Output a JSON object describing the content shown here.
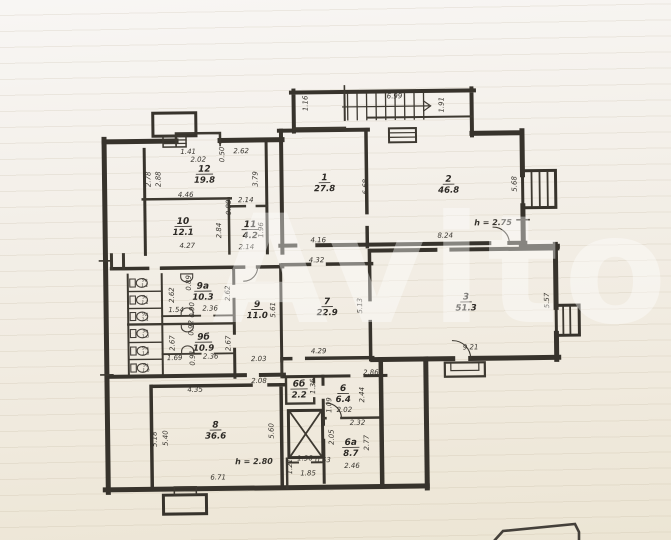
{
  "photo": {
    "watermark": "Avito",
    "colors": {
      "paper": "#f2eee6",
      "ink": "#37332c",
      "watermark": "#ffffff"
    }
  },
  "plan": {
    "rooms": [
      {
        "num": "1",
        "area": "27.8",
        "x": 326,
        "y": 180
      },
      {
        "num": "2",
        "area": "46.8",
        "x": 450,
        "y": 183
      },
      {
        "num": "3",
        "area": "51.3",
        "x": 466,
        "y": 301
      },
      {
        "num": "6",
        "area": "6.4",
        "x": 342,
        "y": 391
      },
      {
        "num": "6а",
        "area": "8.7",
        "x": 349,
        "y": 445
      },
      {
        "num": "6б",
        "area": "2.2",
        "x": 298,
        "y": 386
      },
      {
        "num": "7",
        "area": "22.9",
        "x": 327,
        "y": 304
      },
      {
        "num": "8",
        "area": "36.6",
        "x": 214,
        "y": 426
      },
      {
        "num": "9",
        "area": "11.0",
        "x": 257,
        "y": 306
      },
      {
        "num": "9а",
        "area": "10.3",
        "x": 203,
        "y": 287
      },
      {
        "num": "9б",
        "area": "10.9",
        "x": 203,
        "y": 338
      },
      {
        "num": "10",
        "area": "12.1",
        "x": 184,
        "y": 222
      },
      {
        "num": "11",
        "area": "4.2",
        "x": 251,
        "y": 226
      },
      {
        "num": "12",
        "area": "19.8",
        "x": 206,
        "y": 170
      }
    ],
    "stalls": [
      {
        "num": "9в",
        "area": "1.1",
        "x": 145,
        "y": 279
      },
      {
        "num": "9г",
        "area": "1.1",
        "x": 145,
        "y": 296
      },
      {
        "num": "9д",
        "area": "1.1",
        "x": 145,
        "y": 313
      },
      {
        "num": "9е",
        "area": "1.0",
        "x": 145,
        "y": 330
      },
      {
        "num": "9ж",
        "area": "1.0",
        "x": 145,
        "y": 347
      },
      {
        "num": "9з",
        "area": "1.0",
        "x": 145,
        "y": 364
      }
    ],
    "dims": [
      {
        "t": "1.16",
        "x": 310,
        "y": 103,
        "v": 1
      },
      {
        "t": "6.99",
        "x": 397,
        "y": 99,
        "v": 0
      },
      {
        "t": "1.91",
        "x": 446,
        "y": 106,
        "v": 1
      },
      {
        "t": "1.41",
        "x": 190,
        "y": 152,
        "v": 0
      },
      {
        "t": "2.02",
        "x": 200,
        "y": 160,
        "v": 0
      },
      {
        "t": "0.50",
        "x": 226,
        "y": 153,
        "v": 1
      },
      {
        "t": "2.62",
        "x": 243,
        "y": 152,
        "v": 0
      },
      {
        "t": "2.78",
        "x": 152,
        "y": 177,
        "v": 1
      },
      {
        "t": "2.88",
        "x": 162,
        "y": 177,
        "v": 1
      },
      {
        "t": "3.79",
        "x": 259,
        "y": 178,
        "v": 1
      },
      {
        "t": "4.46",
        "x": 187,
        "y": 195,
        "v": 0
      },
      {
        "t": "2.14",
        "x": 247,
        "y": 201,
        "v": 0
      },
      {
        "t": "0.89",
        "x": 232,
        "y": 206,
        "v": 1
      },
      {
        "t": "2.84",
        "x": 222,
        "y": 229,
        "v": 1
      },
      {
        "t": "1.96",
        "x": 264,
        "y": 229,
        "v": 1
      },
      {
        "t": "4.27",
        "x": 188,
        "y": 246,
        "v": 0
      },
      {
        "t": "2.14",
        "x": 247,
        "y": 248,
        "v": 0
      },
      {
        "t": "6.68",
        "x": 369,
        "y": 187,
        "v": 1
      },
      {
        "t": "4.16",
        "x": 319,
        "y": 242,
        "v": 0
      },
      {
        "t": "5.68",
        "x": 518,
        "y": 186,
        "v": 1
      },
      {
        "t": "8.24",
        "x": 446,
        "y": 239,
        "v": 0
      },
      {
        "t": "4.32",
        "x": 317,
        "y": 262,
        "v": 0
      },
      {
        "t": "5.13",
        "x": 362,
        "y": 306,
        "v": 1
      },
      {
        "t": "4.29",
        "x": 318,
        "y": 353,
        "v": 0
      },
      {
        "t": "5.57",
        "x": 549,
        "y": 303,
        "v": 1
      },
      {
        "t": "9.21",
        "x": 470,
        "y": 351,
        "v": 0
      },
      {
        "t": "5.61",
        "x": 275,
        "y": 309,
        "v": 1
      },
      {
        "t": "2.03",
        "x": 258,
        "y": 360,
        "v": 0
      },
      {
        "t": "2.08",
        "x": 258,
        "y": 382,
        "v": 0
      },
      {
        "t": "0.89",
        "x": 191,
        "y": 281,
        "v": 1
      },
      {
        "t": "2.62",
        "x": 174,
        "y": 293,
        "v": 1
      },
      {
        "t": "2.62",
        "x": 230,
        "y": 292,
        "v": 1
      },
      {
        "t": "1.54",
        "x": 176,
        "y": 310,
        "v": 0
      },
      {
        "t": "0.90",
        "x": 194,
        "y": 308,
        "v": 1
      },
      {
        "t": "2.36",
        "x": 210,
        "y": 309,
        "v": 0
      },
      {
        "t": "0.92",
        "x": 193,
        "y": 326,
        "v": 1
      },
      {
        "t": "2.67",
        "x": 174,
        "y": 341,
        "v": 1
      },
      {
        "t": "2.67",
        "x": 230,
        "y": 342,
        "v": 1
      },
      {
        "t": "1.69",
        "x": 174,
        "y": 358,
        "v": 0
      },
      {
        "t": "0.91",
        "x": 194,
        "y": 356,
        "v": 1
      },
      {
        "t": "2.36",
        "x": 210,
        "y": 357,
        "v": 0
      },
      {
        "t": "4.35",
        "x": 194,
        "y": 390,
        "v": 0
      },
      {
        "t": "5.18",
        "x": 155,
        "y": 437,
        "v": 1
      },
      {
        "t": "5.40",
        "x": 166,
        "y": 436,
        "v": 1
      },
      {
        "t": "5.60",
        "x": 272,
        "y": 430,
        "v": 1
      },
      {
        "t": "6.71",
        "x": 216,
        "y": 478,
        "v": 0
      },
      {
        "t": "2.86",
        "x": 370,
        "y": 375,
        "v": 0
      },
      {
        "t": "1.36",
        "x": 314,
        "y": 386,
        "v": 1
      },
      {
        "t": "2.44",
        "x": 363,
        "y": 395,
        "v": 1
      },
      {
        "t": "1.09",
        "x": 330,
        "y": 405,
        "v": 1
      },
      {
        "t": "2.02",
        "x": 343,
        "y": 412,
        "v": 0
      },
      {
        "t": "2.32",
        "x": 356,
        "y": 425,
        "v": 0
      },
      {
        "t": "2.05",
        "x": 332,
        "y": 437,
        "v": 1
      },
      {
        "t": "2.77",
        "x": 367,
        "y": 443,
        "v": 1
      },
      {
        "t": "2.46",
        "x": 350,
        "y": 468,
        "v": 0
      },
      {
        "t": "1.36",
        "x": 303,
        "y": 460,
        "v": 0
      },
      {
        "t": "0.63",
        "x": 321,
        "y": 462,
        "v": 0
      },
      {
        "t": "1.85",
        "x": 306,
        "y": 475,
        "v": 0
      },
      {
        "t": "1.21",
        "x": 290,
        "y": 466,
        "v": 1
      }
    ],
    "notes": [
      {
        "t": "h = 2.75",
        "x": 494,
        "y": 227
      },
      {
        "t": "h = 2.80",
        "x": 252,
        "y": 463
      }
    ]
  }
}
